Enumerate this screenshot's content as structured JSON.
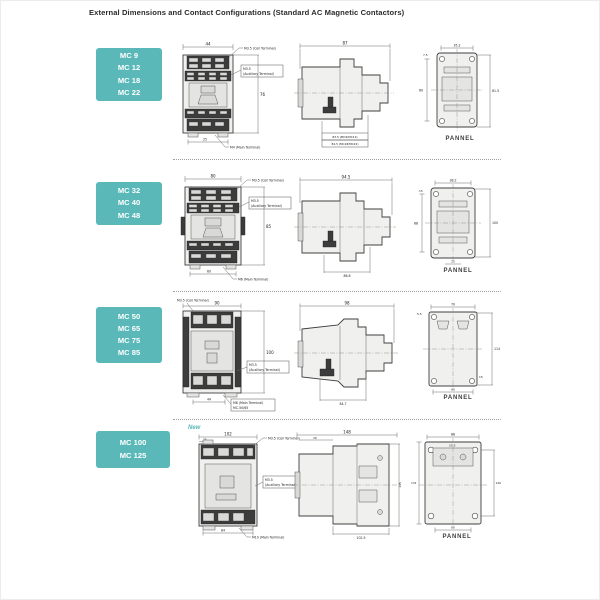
{
  "page": {
    "title": "External Dimensions and Contact Configurations (Standard AC Magnetic Contactors)",
    "new_tag": "New"
  },
  "colors": {
    "teal": "#5ab8b8",
    "line": "#4a4a4a",
    "dark_fill": "#3c3c3c",
    "light_fill": "#f0f0ee"
  },
  "rows": [
    {
      "models": [
        "MC 9",
        "MC 12",
        "MC 18",
        "MC 22"
      ],
      "front": {
        "dim_top": "44",
        "dim_right": "76",
        "dim_bottom": "25",
        "callout_coil": "M3.5 (Coil Terminal)",
        "callout_aux_1": "M3.5",
        "callout_aux_2": "(Auxiliary Terminal)",
        "callout_main": "M4 (Main Terminal)"
      },
      "side": {
        "dim_top": "87",
        "depth_row_1": "83.5 (MC9/MC12)",
        "depth_row_2": "84.5 (MC18/MC22)"
      },
      "panel": {
        "dim_top": "35.2",
        "dim_top_left": "7.5",
        "dim_left": "60",
        "dim_right": "81.5",
        "label": "PANNEL"
      }
    },
    {
      "models": [
        "MC 32",
        "MC 40",
        "MC 48"
      ],
      "front": {
        "dim_top": "80",
        "dim_right": "85",
        "dim_bottom": "60",
        "callout_coil": "M3.5 (Coil Terminal)",
        "callout_aux_1": "M3.5",
        "callout_aux_2": "(Auxiliary Terminal)",
        "callout_main": "M6 (Main Terminal)"
      },
      "side": {
        "dim_top": "94.5",
        "dim_bottom": "86.8"
      },
      "panel": {
        "dim_top": "38.2",
        "dim_top_left": "15",
        "dim_left": "68",
        "dim_right": "100",
        "dim_bottom": "25",
        "label": "PANNEL"
      }
    },
    {
      "models": [
        "MC 50",
        "MC 65",
        "MC 75",
        "MC 85"
      ],
      "front": {
        "dim_top": "90",
        "dim_right": "100",
        "dim_bottom": "44",
        "callout_coil": "M3.5 (Coil Terminal)",
        "callout_aux_1": "M3.5",
        "callout_aux_2": "(Auxiliary Terminal)",
        "callout_main": "M8 (Main Terminal)",
        "callout_main_2": "MC-50/65"
      },
      "side": {
        "dim_top": "98",
        "dim_bottom": "84.7"
      },
      "panel": {
        "dim_top": "70",
        "dim_top_left": "5.5",
        "dim_right": "114",
        "dim_bottom": "60",
        "dim_bottom_right": "15",
        "label": "PANNEL"
      }
    },
    {
      "models": [
        "MC 100",
        "MC 125"
      ],
      "front": {
        "dim_top": "102",
        "dim_top_left": "25",
        "dim_bottom": "84",
        "callout_coil": "M3.5 (Coil Terminal)",
        "callout_aux_1": "M3.5",
        "callout_aux_2": "(Auxiliary Terminal)",
        "callout_main": "M10 (Main Terminal)"
      },
      "side": {
        "dim_top": "148",
        "dim_top_left": "30",
        "dim_right": "145",
        "dim_bottom": "102.5"
      },
      "panel": {
        "dim_top": "88",
        "dim_inner": "25.5",
        "dim_left": "131",
        "dim_right": "120",
        "dim_bottom": "60",
        "label": "PANNEL"
      }
    }
  ]
}
